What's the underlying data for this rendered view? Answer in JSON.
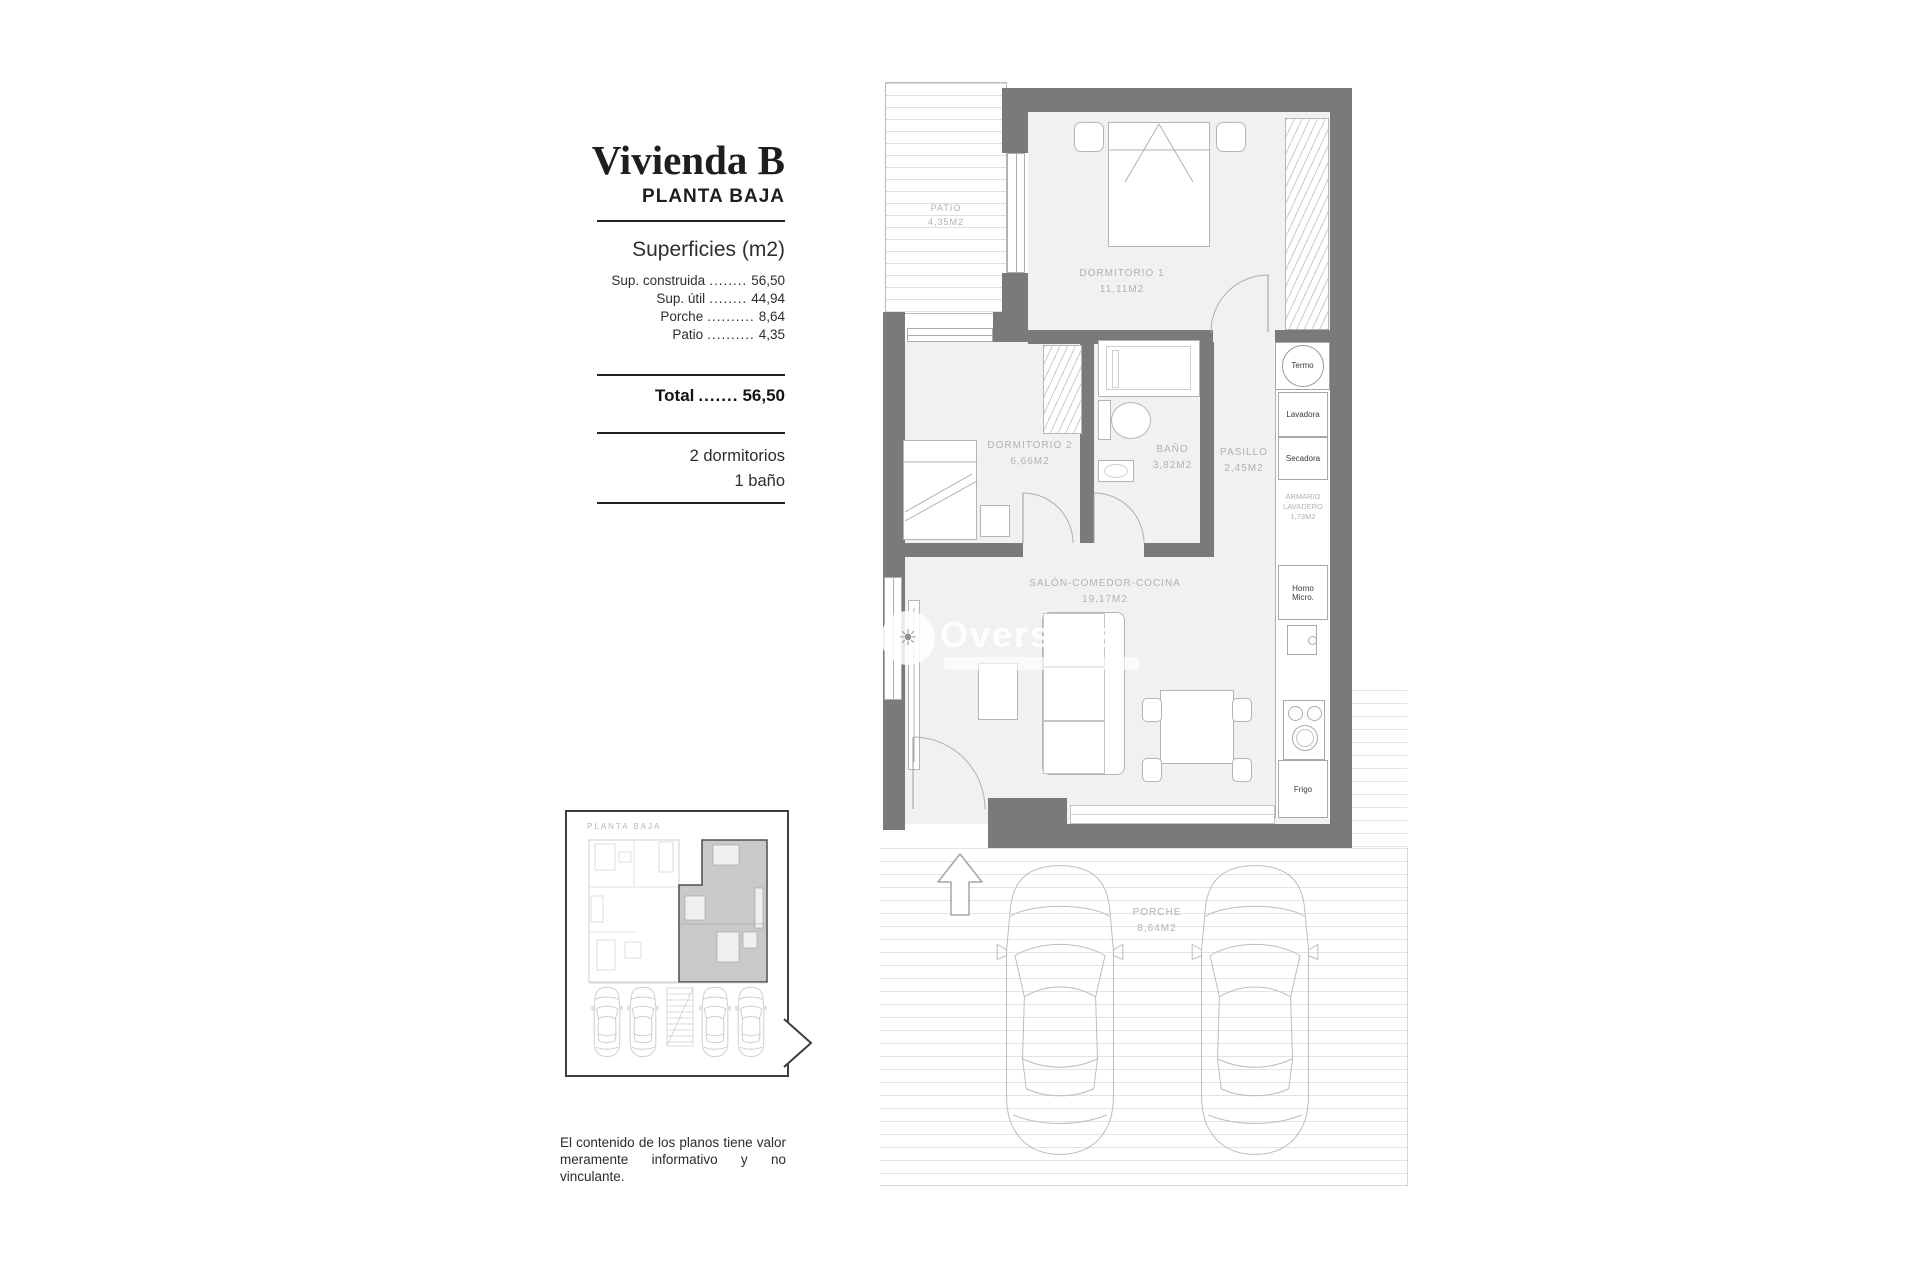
{
  "title_block": {
    "title": "Vivienda B",
    "subtitle": "PLANTA BAJA",
    "section_title": "Superficies (m2)",
    "rows": [
      {
        "label": "Sup. construida",
        "dots": "........",
        "value": "56,50"
      },
      {
        "label": "Sup. útil",
        "dots": "........",
        "value": "44,94"
      },
      {
        "label": "Porche",
        "dots": "..........",
        "value": "8,64"
      },
      {
        "label": "Patio",
        "dots": "..........",
        "value": "4,35"
      }
    ],
    "total": {
      "label": "Total",
      "dots": ".......",
      "value": "56,50"
    },
    "features": [
      "2 dormitorios",
      "1 baño"
    ]
  },
  "plan": {
    "rooms": {
      "patio": {
        "name": "PATIO",
        "area": "4,35m2"
      },
      "dormitorio1": {
        "name": "DORMITORIO 1",
        "area": "11,11m2"
      },
      "dormitorio2": {
        "name": "DORMITORIO 2",
        "area": "6,66m2"
      },
      "bano": {
        "name": "BAÑO",
        "area": "3,82m2"
      },
      "pasillo": {
        "name": "PASILLO",
        "area": "2,45m2"
      },
      "salon": {
        "name": "SALÓN-COMEDOR-COCINA",
        "area": "19,17m2"
      },
      "porche": {
        "name": "PORCHE",
        "area": "8,64m2"
      }
    },
    "closet": {
      "line1": "ARMARIO",
      "line2": "LAVADERO",
      "area": "1,73m2"
    },
    "appliances": {
      "termo": "Termo",
      "lavadora": "Lavadora",
      "secadora": "Secadora",
      "horno_line1": "Horno",
      "horno_line2": "Micro.",
      "frigo": "Frigo"
    }
  },
  "inset": {
    "label": "PLANTA BAJA"
  },
  "watermark": {
    "brand": "Overseas"
  },
  "disclaimer": {
    "line1": "El contenido de los planos tiene valor",
    "line2": "meramente informativo y no vinculante."
  },
  "colors": {
    "wall": "#7a7a7a",
    "floor": "#f1f1f1",
    "line": "#b5b5b5",
    "label": "#b2b2b2",
    "ink": "#1d1d1d"
  }
}
